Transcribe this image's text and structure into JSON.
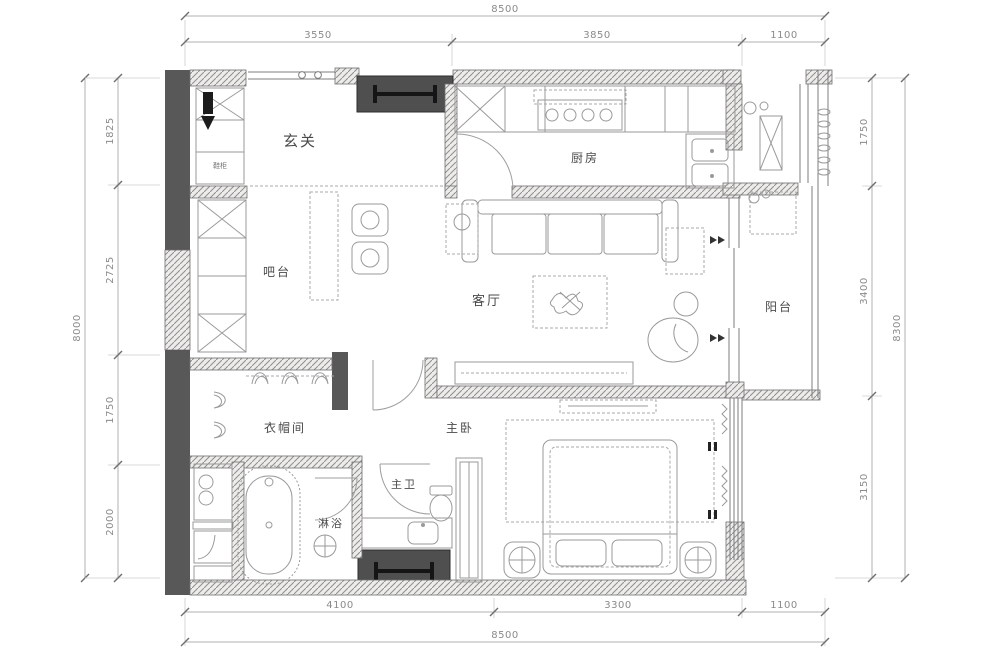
{
  "plan": {
    "rooms": {
      "entry": "玄关",
      "kitchen": "厨房",
      "bar": "吧台",
      "living_room": "客厅",
      "balcony": "阳台",
      "cloakroom": "衣帽间",
      "master_bedroom": "主卧",
      "master_bathroom": "主卫",
      "shower": "淋浴",
      "shoe_cabinet": "鞋柜"
    },
    "dimensions": {
      "top": {
        "total": "8500",
        "segments": [
          "3550",
          "3850",
          "1100"
        ]
      },
      "bottom": {
        "total": "8500",
        "segments": [
          "4100",
          "3300",
          "1100"
        ]
      },
      "left": {
        "total": "8000",
        "segments": [
          "1825",
          "2725",
          "1750",
          "2000"
        ]
      },
      "right": {
        "total": "8300",
        "segments": [
          "1750",
          "3400",
          "3150"
        ]
      }
    },
    "colors": {
      "wall_dark": "#585858",
      "beam_box": "#4f4f4f",
      "hatch_line": "#8f8f8f",
      "furniture_line": "#9a9a9a",
      "dimension_text": "#8a8a8a",
      "label_text": "#4a4a4a"
    }
  }
}
